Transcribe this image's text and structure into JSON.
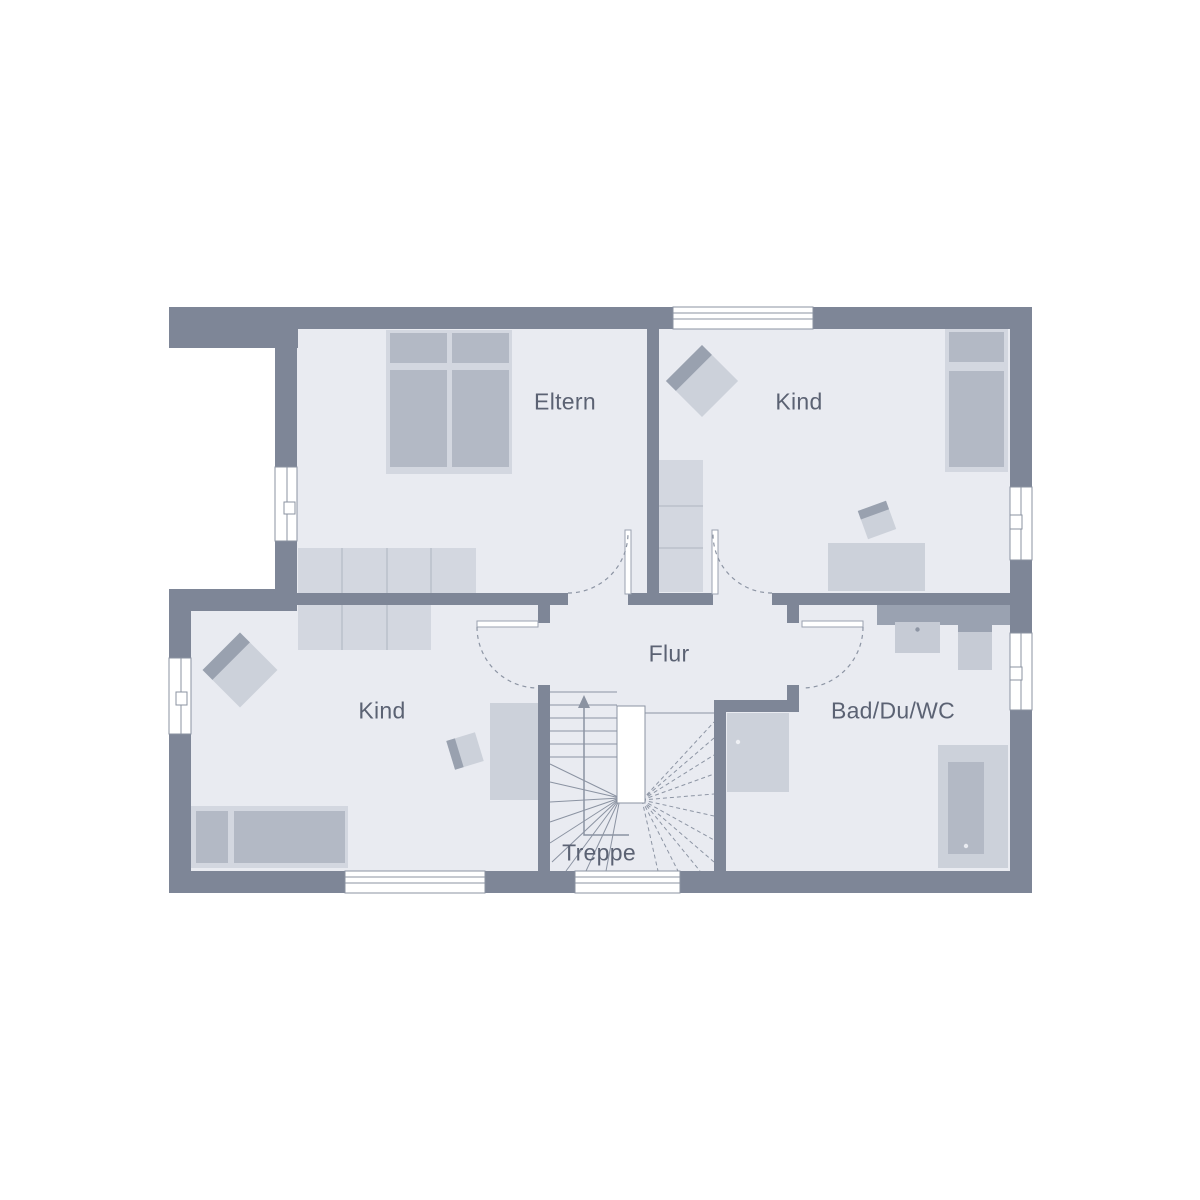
{
  "rooms": {
    "eltern": {
      "label": "Eltern"
    },
    "kind_top": {
      "label": "Kind"
    },
    "kind_bottom": {
      "label": "Kind"
    },
    "flur": {
      "label": "Flur"
    },
    "bad": {
      "label": "Bad/Du/WC"
    },
    "treppe": {
      "label": "Treppe"
    }
  },
  "icons": {
    "stair_direction": "up-arrow"
  },
  "colors": {
    "background": "#ffffff",
    "wall": "#7e8697",
    "floor": "#e9ebf1",
    "furniture_light": "#d3d7e0",
    "furniture_mid": "#ccd1da",
    "furniture_inner": "#b3b9c5",
    "furniture_dark": "#99a1af",
    "fixture": "#c6cbd5",
    "counter": "#9aa2b1",
    "line": "#8b93a2",
    "label_text": "#5b6273"
  }
}
